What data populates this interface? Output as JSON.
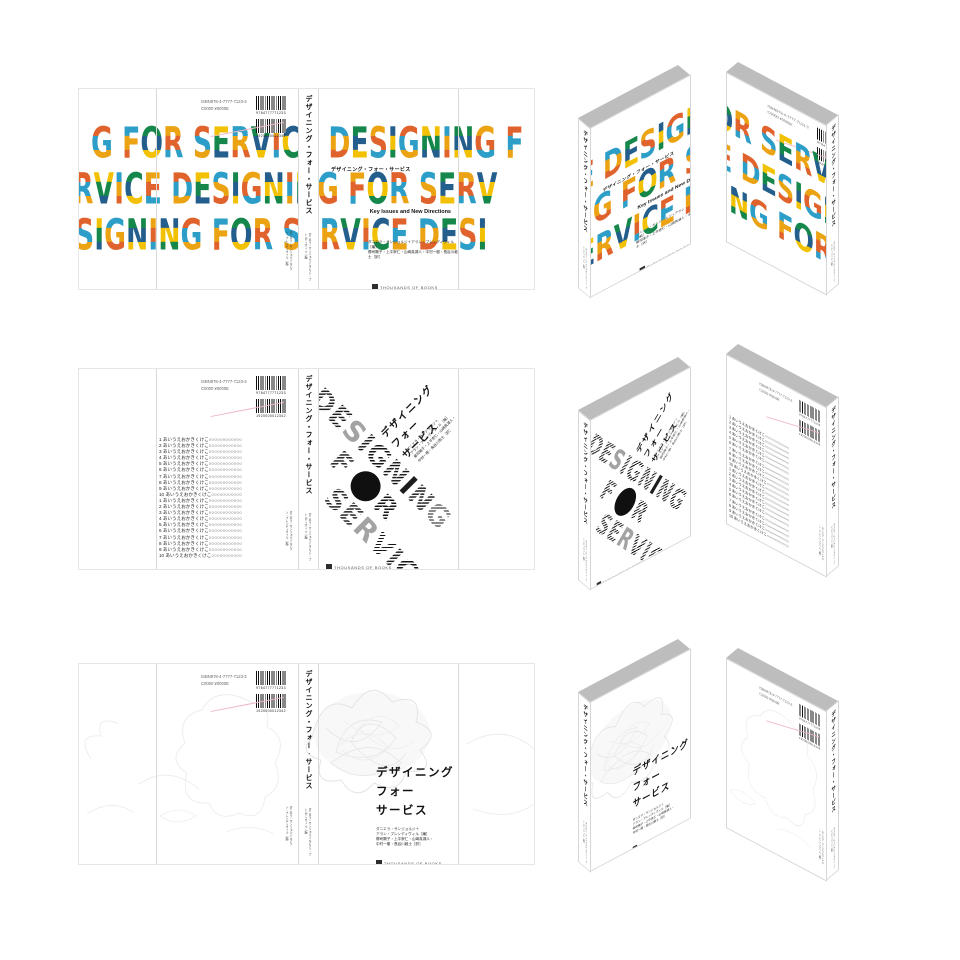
{
  "palette": [
    "#E0622C",
    "#F2C103",
    "#2D9EC7",
    "#15874B",
    "#ECA313",
    "#235E8C"
  ],
  "publisher": {
    "name": "THOUSANDS OF BOOKS"
  },
  "barcode": {
    "isbn": "ISBN978-4-7777-7123-3",
    "price_code": "C0000 ¥0000E",
    "ean1": "9784777771233",
    "ean2": "1920000012342"
  },
  "book": {
    "title_jp": "デザイニング・フォー・サービス",
    "title_lines": [
      "デザイニング",
      "フォー",
      "サービス"
    ],
    "subtitle_en": "Key Issues and New Directions",
    "credits_line1": "ダニエラ・サンジョルジ＋アラン・プレンディヴィル［編］",
    "credits_line2": "郷司陽子・上平崇仁・山崎真湖人・中村一樹・長谷川敦士［訳］",
    "credits_lines": [
      "ダニエラ・サンジョルジ＋",
      "アラン・プレンディヴィル［編］",
      "郷司陽子・上平崇仁・山崎真湖人・",
      "中村一樹・長谷川敦士［訳］"
    ],
    "spine_credits": "ダニエラ・サンジョルジ＋アラン・プレンディヴィル［編］"
  },
  "design1": {
    "lines": [
      "G FOR SERVICE DESIGNING F",
      "RVICE DESIGNING FOR SERV",
      "SIGNING FOR SERVICE DESI"
    ]
  },
  "design2": {
    "word1": "DESIGNING",
    "letter_f": "F",
    "letter_r": "R",
    "word3": "SERVICE",
    "back_list": [
      "1 あいうえおかきくけこ○○○○○○○○○○○○",
      "2 あいうえおかきくけこ○○○○○○○○○○○○",
      "3 あいうえおかきくけこ○○○○○○○○○○○○",
      "4 あいうえおかきくけこ○○○○○○○○○○○○",
      "5 あいうえおかきくけこ○○○○○○○○○○○○",
      "6 あいうえおかきくけこ○○○○○○○○○○○○",
      "7 あいうえおかきくけこ○○○○○○○○○○○○",
      "8 あいうえおかきくけこ○○○○○○○○○○○○",
      "9 あいうえおかきくけこ○○○○○○○○○○○○",
      "10 あいうえおかきくけこ○○○○○○○○○○○",
      "1 あいうえおかきくけこ○○○○○○○○○○○○",
      "2 あいうえおかきくけこ○○○○○○○○○○○○",
      "3 あいうえおかきくけこ○○○○○○○○○○○○",
      "4 あいうえおかきくけこ○○○○○○○○○○○○",
      "5 あいうえおかきくけこ○○○○○○○○○○○○",
      "6 あいうえおかきくけこ○○○○○○○○○○○○",
      "7 あいうえおかきくけこ○○○○○○○○○○○○",
      "8 あいうえおかきくけこ○○○○○○○○○○○○",
      "9 あいうえおかきくけこ○○○○○○○○○○○○",
      "10 あいうえおかきくけこ○○○○○○○○○○○"
    ]
  }
}
